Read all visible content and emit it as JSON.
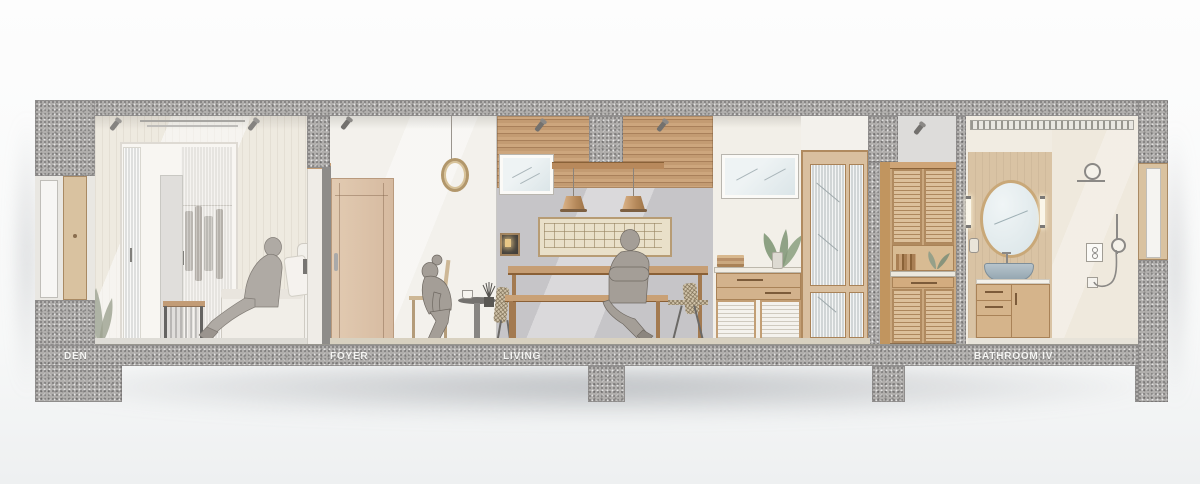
{
  "rooms": [
    {
      "id": "den",
      "label": "DEN"
    },
    {
      "id": "foyer",
      "label": "FOYER"
    },
    {
      "id": "living",
      "label": "LIVING"
    },
    {
      "id": "bathroom",
      "label": "BATHROOM IV"
    }
  ],
  "colors": {
    "concrete": "#b0aeac",
    "concreteDark": "#8f8d8c",
    "wood": "#c9a47c",
    "woodLight": "#dcc4a8",
    "woodDark": "#a97f58",
    "wallWhite": "#f3f1ec",
    "wallBeige": "#ece7dc",
    "wallGray": "#c6c5c8",
    "wallCream": "#efe9dd",
    "floorBeige": "#d8d1c0",
    "glass": "#e4e8e8",
    "figure": "#a49e97",
    "plant": "#9aa08e",
    "basin": "#a4b4bf",
    "lampGlow": "#e9c887",
    "label": "#f5f5f3"
  }
}
